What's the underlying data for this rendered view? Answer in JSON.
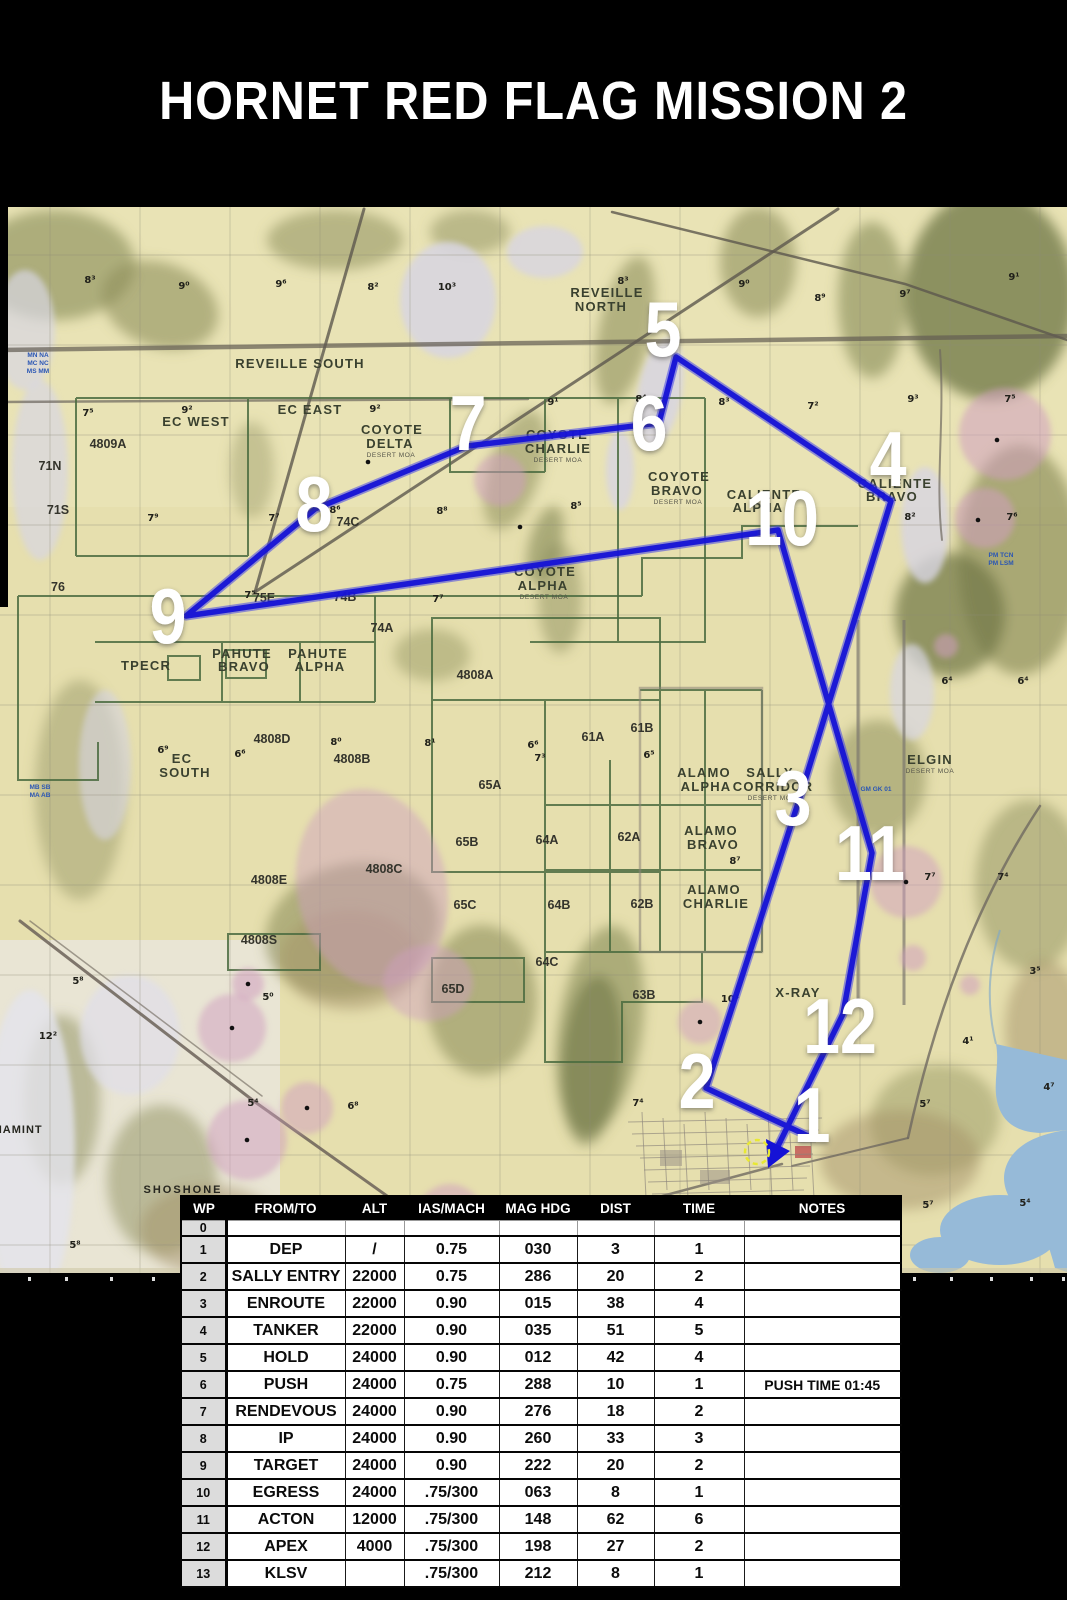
{
  "title": "HORNET RED FLAG MISSION 2",
  "colors": {
    "background": "#000000",
    "route_blue": "#1512d6",
    "map_base_tan": "#e6dfae",
    "water_blue": "#96bad8",
    "airspace_pink": "#cf9ec0",
    "boundary_green": "#4a6b40",
    "table_header_bg": "#000000",
    "wp_column_bg": "#dcdcdc"
  },
  "table": {
    "headers": [
      "WP",
      "FROM/TO",
      "ALT",
      "IAS/MACH",
      "MAG HDG",
      "DIST",
      "TIME",
      "NOTES"
    ],
    "rows": [
      [
        "0",
        "",
        "",
        "",
        "",
        "",
        "",
        ""
      ],
      [
        "1",
        "DEP",
        "/",
        "0.75",
        "030",
        "3",
        "1",
        ""
      ],
      [
        "2",
        "SALLY ENTRY",
        "22000",
        "0.75",
        "286",
        "20",
        "2",
        ""
      ],
      [
        "3",
        "ENROUTE",
        "22000",
        "0.90",
        "015",
        "38",
        "4",
        ""
      ],
      [
        "4",
        "TANKER",
        "22000",
        "0.90",
        "035",
        "51",
        "5",
        ""
      ],
      [
        "5",
        "HOLD",
        "24000",
        "0.90",
        "012",
        "42",
        "4",
        ""
      ],
      [
        "6",
        "PUSH",
        "24000",
        "0.75",
        "288",
        "10",
        "1",
        "PUSH TIME 01:45"
      ],
      [
        "7",
        "RENDEVOUS",
        "24000",
        "0.90",
        "276",
        "18",
        "2",
        ""
      ],
      [
        "8",
        "IP",
        "24000",
        "0.90",
        "260",
        "33",
        "3",
        ""
      ],
      [
        "9",
        "TARGET",
        "24000",
        "0.90",
        "222",
        "20",
        "2",
        ""
      ],
      [
        "10",
        "EGRESS",
        "24000",
        ".75/300",
        "063",
        "8",
        "1",
        ""
      ],
      [
        "11",
        "ACTON",
        "12000",
        ".75/300",
        "148",
        "62",
        "6",
        ""
      ],
      [
        "12",
        "APEX",
        "4000",
        ".75/300",
        "198",
        "27",
        "2",
        ""
      ],
      [
        "13",
        "KLSV",
        "",
        ".75/300",
        "212",
        "8",
        "1",
        ""
      ]
    ]
  },
  "map": {
    "route_points": "808,1136 706,1088 800,797 891,501 676,357 659,423 467,446 315,509 186,616 778,530 872,853 843,1014 778,1146",
    "arrow_points": "768,1168 766,1139 790,1151",
    "klsv": {
      "x": 757,
      "y": 1152
    },
    "waypoints": [
      {
        "n": "1",
        "x": 812,
        "y": 1114
      },
      {
        "n": "2",
        "x": 697,
        "y": 1080
      },
      {
        "n": "3",
        "x": 793,
        "y": 797
      },
      {
        "n": "4",
        "x": 888,
        "y": 458
      },
      {
        "n": "5",
        "x": 663,
        "y": 328
      },
      {
        "n": "6",
        "x": 649,
        "y": 422
      },
      {
        "n": "7",
        "x": 468,
        "y": 422
      },
      {
        "n": "8",
        "x": 314,
        "y": 503
      },
      {
        "n": "9",
        "x": 168,
        "y": 615
      },
      {
        "n": "10",
        "x": 782,
        "y": 517
      },
      {
        "n": "11",
        "x": 870,
        "y": 852
      },
      {
        "n": "12",
        "x": 840,
        "y": 1025
      }
    ],
    "labels": [
      {
        "t": "REVEILLE SOUTH",
        "x": 300,
        "y": 368,
        "c": "range",
        "ls": 3
      },
      {
        "t": "REVEILLE",
        "x": 607,
        "y": 297,
        "c": "range"
      },
      {
        "t": "NORTH",
        "x": 601,
        "y": 311,
        "c": "range"
      },
      {
        "t": "EC WEST",
        "x": 196,
        "y": 426,
        "c": "range"
      },
      {
        "t": "EC EAST",
        "x": 310,
        "y": 414,
        "c": "range"
      },
      {
        "t": "COYOTE",
        "x": 392,
        "y": 434,
        "c": "range"
      },
      {
        "t": "DELTA",
        "x": 390,
        "y": 448,
        "c": "range"
      },
      {
        "t": "DESERT MOA",
        "x": 391,
        "y": 457,
        "c": "tiny"
      },
      {
        "t": "COYOTE",
        "x": 557,
        "y": 439,
        "c": "range"
      },
      {
        "t": "CHARLIE",
        "x": 558,
        "y": 453,
        "c": "range"
      },
      {
        "t": "DESERT MOA",
        "x": 558,
        "y": 462,
        "c": "tiny"
      },
      {
        "t": "COYOTE",
        "x": 679,
        "y": 481,
        "c": "range"
      },
      {
        "t": "BRAVO",
        "x": 677,
        "y": 495,
        "c": "range"
      },
      {
        "t": "DESERT MOA",
        "x": 678,
        "y": 504,
        "c": "tiny"
      },
      {
        "t": "COYOTE",
        "x": 545,
        "y": 576,
        "c": "range"
      },
      {
        "t": "ALPHA",
        "x": 543,
        "y": 590,
        "c": "range"
      },
      {
        "t": "DESERT MOA",
        "x": 544,
        "y": 599,
        "c": "tiny"
      },
      {
        "t": "CALIENTE",
        "x": 764,
        "y": 499,
        "c": "range"
      },
      {
        "t": "ALPHA",
        "x": 758,
        "y": 512,
        "c": "range"
      },
      {
        "t": "CALIENTE",
        "x": 895,
        "y": 488,
        "c": "range"
      },
      {
        "t": "BRAVO",
        "x": 892,
        "y": 501,
        "c": "range"
      },
      {
        "t": "TPECR",
        "x": 146,
        "y": 670,
        "c": "range"
      },
      {
        "t": "PAHUTE",
        "x": 242,
        "y": 658,
        "c": "range"
      },
      {
        "t": "BRAVO",
        "x": 244,
        "y": 671,
        "c": "range"
      },
      {
        "t": "PAHUTE",
        "x": 318,
        "y": 658,
        "c": "range"
      },
      {
        "t": "ALPHA",
        "x": 320,
        "y": 671,
        "c": "range"
      },
      {
        "t": "EC",
        "x": 182,
        "y": 763,
        "c": "range"
      },
      {
        "t": "SOUTH",
        "x": 185,
        "y": 777,
        "c": "range"
      },
      {
        "t": "ALAMO",
        "x": 704,
        "y": 777,
        "c": "range"
      },
      {
        "t": "ALPHA",
        "x": 706,
        "y": 791,
        "c": "range"
      },
      {
        "t": "SALLY",
        "x": 770,
        "y": 777,
        "c": "range"
      },
      {
        "t": "CORRIDOR",
        "x": 773,
        "y": 791,
        "c": "range"
      },
      {
        "t": "DESERT MOA",
        "x": 772,
        "y": 800,
        "c": "tiny"
      },
      {
        "t": "ALAMO",
        "x": 711,
        "y": 835,
        "c": "range"
      },
      {
        "t": "BRAVO",
        "x": 713,
        "y": 849,
        "c": "range"
      },
      {
        "t": "ALAMO",
        "x": 714,
        "y": 894,
        "c": "range"
      },
      {
        "t": "CHARLIE",
        "x": 716,
        "y": 908,
        "c": "range"
      },
      {
        "t": "ELGIN",
        "x": 930,
        "y": 764,
        "c": "range"
      },
      {
        "t": "DESERT MOA",
        "x": 930,
        "y": 773,
        "c": "tiny"
      },
      {
        "t": "X-RAY",
        "x": 798,
        "y": 997,
        "c": "range"
      },
      {
        "t": "SHOSHONE",
        "x": 183,
        "y": 1193,
        "c": "city",
        "ls": 2
      },
      {
        "t": "PANAMINT",
        "x": 10,
        "y": 1133,
        "c": "city",
        "ls": 1
      },
      {
        "t": "4809A",
        "x": 108,
        "y": 448,
        "c": "code"
      },
      {
        "t": "71N",
        "x": 50,
        "y": 470,
        "c": "code"
      },
      {
        "t": "71S",
        "x": 58,
        "y": 514,
        "c": "code"
      },
      {
        "t": "74C",
        "x": 348,
        "y": 526,
        "c": "code"
      },
      {
        "t": "76",
        "x": 58,
        "y": 591,
        "c": "code"
      },
      {
        "t": "75E",
        "x": 264,
        "y": 602,
        "c": "code"
      },
      {
        "t": "74B",
        "x": 345,
        "y": 601,
        "c": "code"
      },
      {
        "t": "74A",
        "x": 382,
        "y": 632,
        "c": "code"
      },
      {
        "t": "4808A",
        "x": 475,
        "y": 679,
        "c": "code"
      },
      {
        "t": "4808D",
        "x": 272,
        "y": 743,
        "c": "code"
      },
      {
        "t": "4808B",
        "x": 352,
        "y": 763,
        "c": "code"
      },
      {
        "t": "65A",
        "x": 490,
        "y": 789,
        "c": "code"
      },
      {
        "t": "65B",
        "x": 467,
        "y": 846,
        "c": "code"
      },
      {
        "t": "65C",
        "x": 465,
        "y": 909,
        "c": "code"
      },
      {
        "t": "4808C",
        "x": 384,
        "y": 873,
        "c": "code"
      },
      {
        "t": "4808E",
        "x": 269,
        "y": 884,
        "c": "code"
      },
      {
        "t": "61A",
        "x": 593,
        "y": 741,
        "c": "code"
      },
      {
        "t": "61B",
        "x": 642,
        "y": 732,
        "c": "code"
      },
      {
        "t": "62A",
        "x": 629,
        "y": 841,
        "c": "code"
      },
      {
        "t": "62B",
        "x": 642,
        "y": 908,
        "c": "code"
      },
      {
        "t": "64A",
        "x": 547,
        "y": 844,
        "c": "code"
      },
      {
        "t": "64B",
        "x": 559,
        "y": 909,
        "c": "code"
      },
      {
        "t": "64C",
        "x": 547,
        "y": 966,
        "c": "code"
      },
      {
        "t": "63B",
        "x": 644,
        "y": 999,
        "c": "code"
      },
      {
        "t": "65D",
        "x": 453,
        "y": 993,
        "c": "code"
      },
      {
        "t": "4808S",
        "x": 259,
        "y": 944,
        "c": "code"
      },
      {
        "t": "8³",
        "x": 90,
        "y": 283,
        "c": "elev"
      },
      {
        "t": "9⁰",
        "x": 184,
        "y": 289,
        "c": "elev"
      },
      {
        "t": "9⁶",
        "x": 281,
        "y": 287,
        "c": "elev"
      },
      {
        "t": "8²",
        "x": 373,
        "y": 290,
        "c": "elev"
      },
      {
        "t": "10³",
        "x": 447,
        "y": 290,
        "c": "elev"
      },
      {
        "t": "8³",
        "x": 623,
        "y": 284,
        "c": "elev"
      },
      {
        "t": "9⁰",
        "x": 744,
        "y": 287,
        "c": "elev"
      },
      {
        "t": "8⁹",
        "x": 820,
        "y": 301,
        "c": "elev"
      },
      {
        "t": "9⁷",
        "x": 905,
        "y": 297,
        "c": "elev"
      },
      {
        "t": "9¹",
        "x": 1014,
        "y": 280,
        "c": "elev"
      },
      {
        "t": "7⁵",
        "x": 88,
        "y": 416,
        "c": "elev"
      },
      {
        "t": "9²",
        "x": 187,
        "y": 413,
        "c": "elev"
      },
      {
        "t": "9²",
        "x": 375,
        "y": 412,
        "c": "elev"
      },
      {
        "t": "9¹",
        "x": 553,
        "y": 405,
        "c": "elev"
      },
      {
        "t": "8⁴",
        "x": 641,
        "y": 402,
        "c": "elev"
      },
      {
        "t": "8³",
        "x": 724,
        "y": 405,
        "c": "elev"
      },
      {
        "t": "7²",
        "x": 813,
        "y": 409,
        "c": "elev"
      },
      {
        "t": "9³",
        "x": 913,
        "y": 402,
        "c": "elev"
      },
      {
        "t": "7⁵",
        "x": 1010,
        "y": 402,
        "c": "elev"
      },
      {
        "t": "7⁹",
        "x": 153,
        "y": 521,
        "c": "elev"
      },
      {
        "t": "7⁷",
        "x": 274,
        "y": 521,
        "c": "elev"
      },
      {
        "t": "8⁸",
        "x": 442,
        "y": 514,
        "c": "elev"
      },
      {
        "t": "8⁶",
        "x": 335,
        "y": 513,
        "c": "elev"
      },
      {
        "t": "8⁵",
        "x": 576,
        "y": 509,
        "c": "elev"
      },
      {
        "t": "8²",
        "x": 910,
        "y": 520,
        "c": "elev"
      },
      {
        "t": "7⁶",
        "x": 1012,
        "y": 520,
        "c": "elev"
      },
      {
        "t": "7⁵",
        "x": 250,
        "y": 598,
        "c": "elev"
      },
      {
        "t": "7⁷",
        "x": 438,
        "y": 602,
        "c": "elev"
      },
      {
        "t": "6⁹",
        "x": 163,
        "y": 753,
        "c": "elev"
      },
      {
        "t": "6⁶",
        "x": 240,
        "y": 757,
        "c": "elev"
      },
      {
        "t": "8⁰",
        "x": 336,
        "y": 745,
        "c": "elev"
      },
      {
        "t": "8¹",
        "x": 430,
        "y": 746,
        "c": "elev"
      },
      {
        "t": "6⁶",
        "x": 533,
        "y": 748,
        "c": "elev"
      },
      {
        "t": "7³",
        "x": 540,
        "y": 761,
        "c": "elev"
      },
      {
        "t": "6⁵",
        "x": 649,
        "y": 758,
        "c": "elev"
      },
      {
        "t": "6⁴",
        "x": 947,
        "y": 684,
        "c": "elev"
      },
      {
        "t": "6⁴",
        "x": 1023,
        "y": 684,
        "c": "elev"
      },
      {
        "t": "8⁷",
        "x": 735,
        "y": 864,
        "c": "elev"
      },
      {
        "t": "7⁷",
        "x": 930,
        "y": 880,
        "c": "elev"
      },
      {
        "t": "7⁴",
        "x": 1003,
        "y": 880,
        "c": "elev"
      },
      {
        "t": "5⁸",
        "x": 78,
        "y": 984,
        "c": "elev"
      },
      {
        "t": "5⁰",
        "x": 268,
        "y": 1000,
        "c": "elev"
      },
      {
        "t": "5⁴",
        "x": 253,
        "y": 1106,
        "c": "elev"
      },
      {
        "t": "6⁸",
        "x": 353,
        "y": 1109,
        "c": "elev"
      },
      {
        "t": "7⁴",
        "x": 638,
        "y": 1106,
        "c": "elev"
      },
      {
        "t": "10³",
        "x": 730,
        "y": 1002,
        "c": "elev"
      },
      {
        "t": "12²",
        "x": 48,
        "y": 1039,
        "c": "elev"
      },
      {
        "t": "5⁷",
        "x": 925,
        "y": 1107,
        "c": "elev"
      },
      {
        "t": "4⁷",
        "x": 1049,
        "y": 1090,
        "c": "elev"
      },
      {
        "t": "3⁵",
        "x": 1035,
        "y": 974,
        "c": "elev"
      },
      {
        "t": "4¹",
        "x": 968,
        "y": 1044,
        "c": "elev"
      },
      {
        "t": "5⁷",
        "x": 928,
        "y": 1208,
        "c": "elev"
      },
      {
        "t": "5⁴",
        "x": 1025,
        "y": 1206,
        "c": "elev"
      },
      {
        "t": "5⁸",
        "x": 75,
        "y": 1248,
        "c": "elev"
      },
      {
        "t": "MN NA",
        "x": 38,
        "y": 357,
        "c": "blue"
      },
      {
        "t": "MC NC",
        "x": 38,
        "y": 365,
        "c": "blue"
      },
      {
        "t": "MS MM",
        "x": 38,
        "y": 373,
        "c": "blue"
      },
      {
        "t": "MB SB",
        "x": 40,
        "y": 789,
        "c": "blue"
      },
      {
        "t": "MA AB",
        "x": 40,
        "y": 797,
        "c": "blue"
      },
      {
        "t": "GM GK 01",
        "x": 876,
        "y": 791,
        "c": "blue"
      },
      {
        "t": "PM TCN",
        "x": 1001,
        "y": 557,
        "c": "blue"
      },
      {
        "t": "PM LSM",
        "x": 1001,
        "y": 565,
        "c": "blue"
      }
    ]
  }
}
